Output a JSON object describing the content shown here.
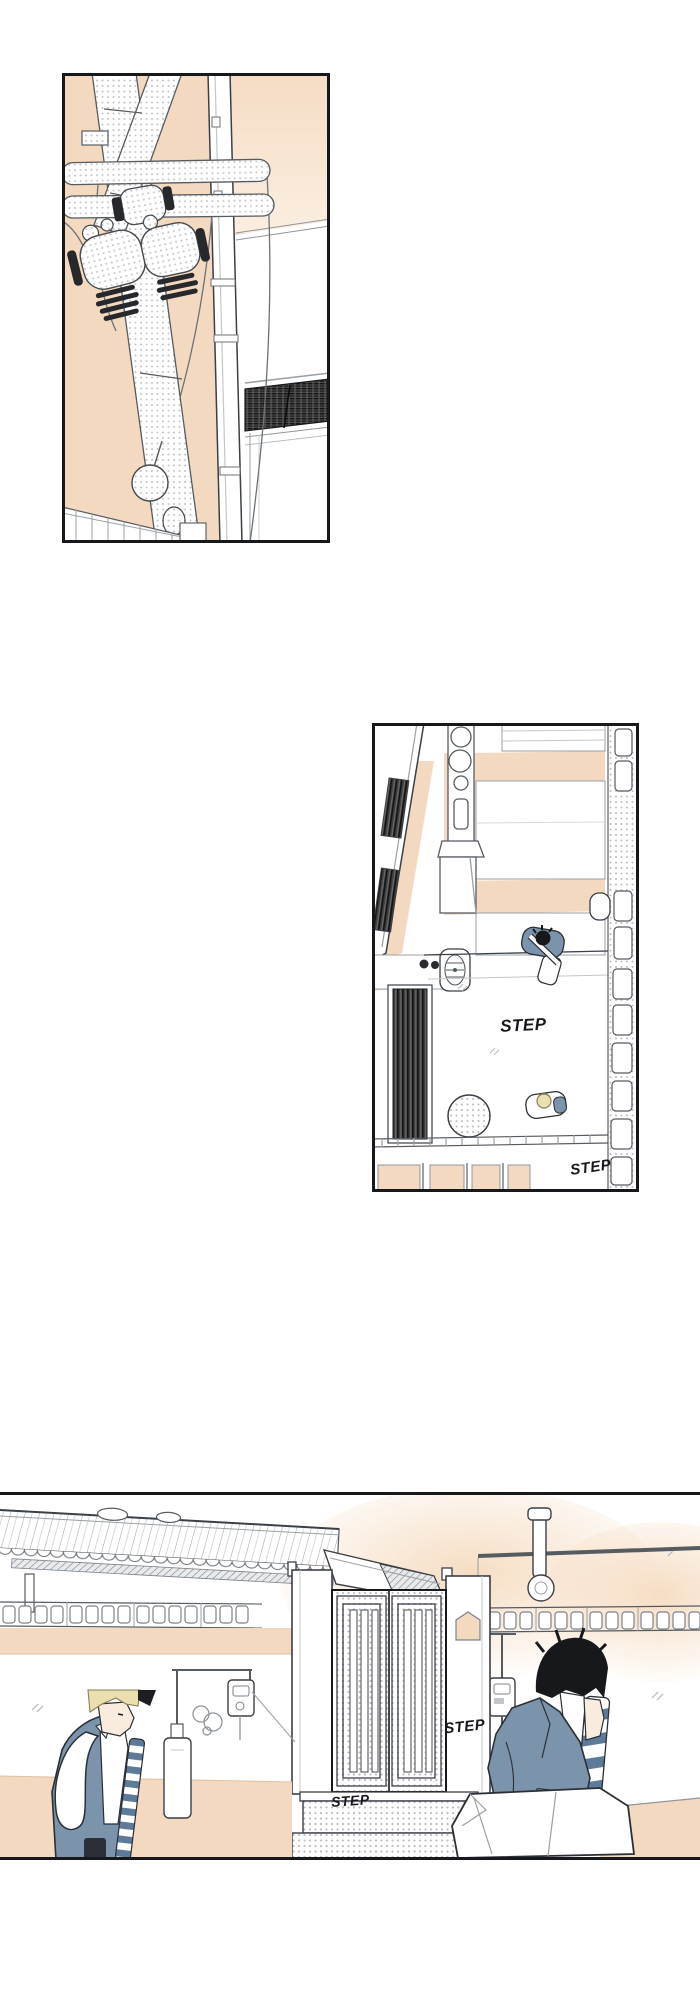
{
  "colors": {
    "peach": "#f3d9c0",
    "peach_glow": "#f7e3cd",
    "ink_outline": "#3b3f46",
    "light_line": "#a6abb1",
    "halftone_dot": "#c6c6c6",
    "dark_hatch": "#3b3b3b",
    "jacket_blue": "#7b93ab",
    "tie_stripe_blue": "#5d7a99",
    "hair_blonde": "#eadfae",
    "hair_black": "#17181c",
    "skin": "#f9ecdf",
    "panel_border": "#17181c"
  },
  "sfx": {
    "panel2": {
      "step_top": "STEP",
      "step_bottom": "STEP"
    },
    "panel3": {
      "step_gate": "STEP",
      "step_base": "STEP"
    }
  }
}
